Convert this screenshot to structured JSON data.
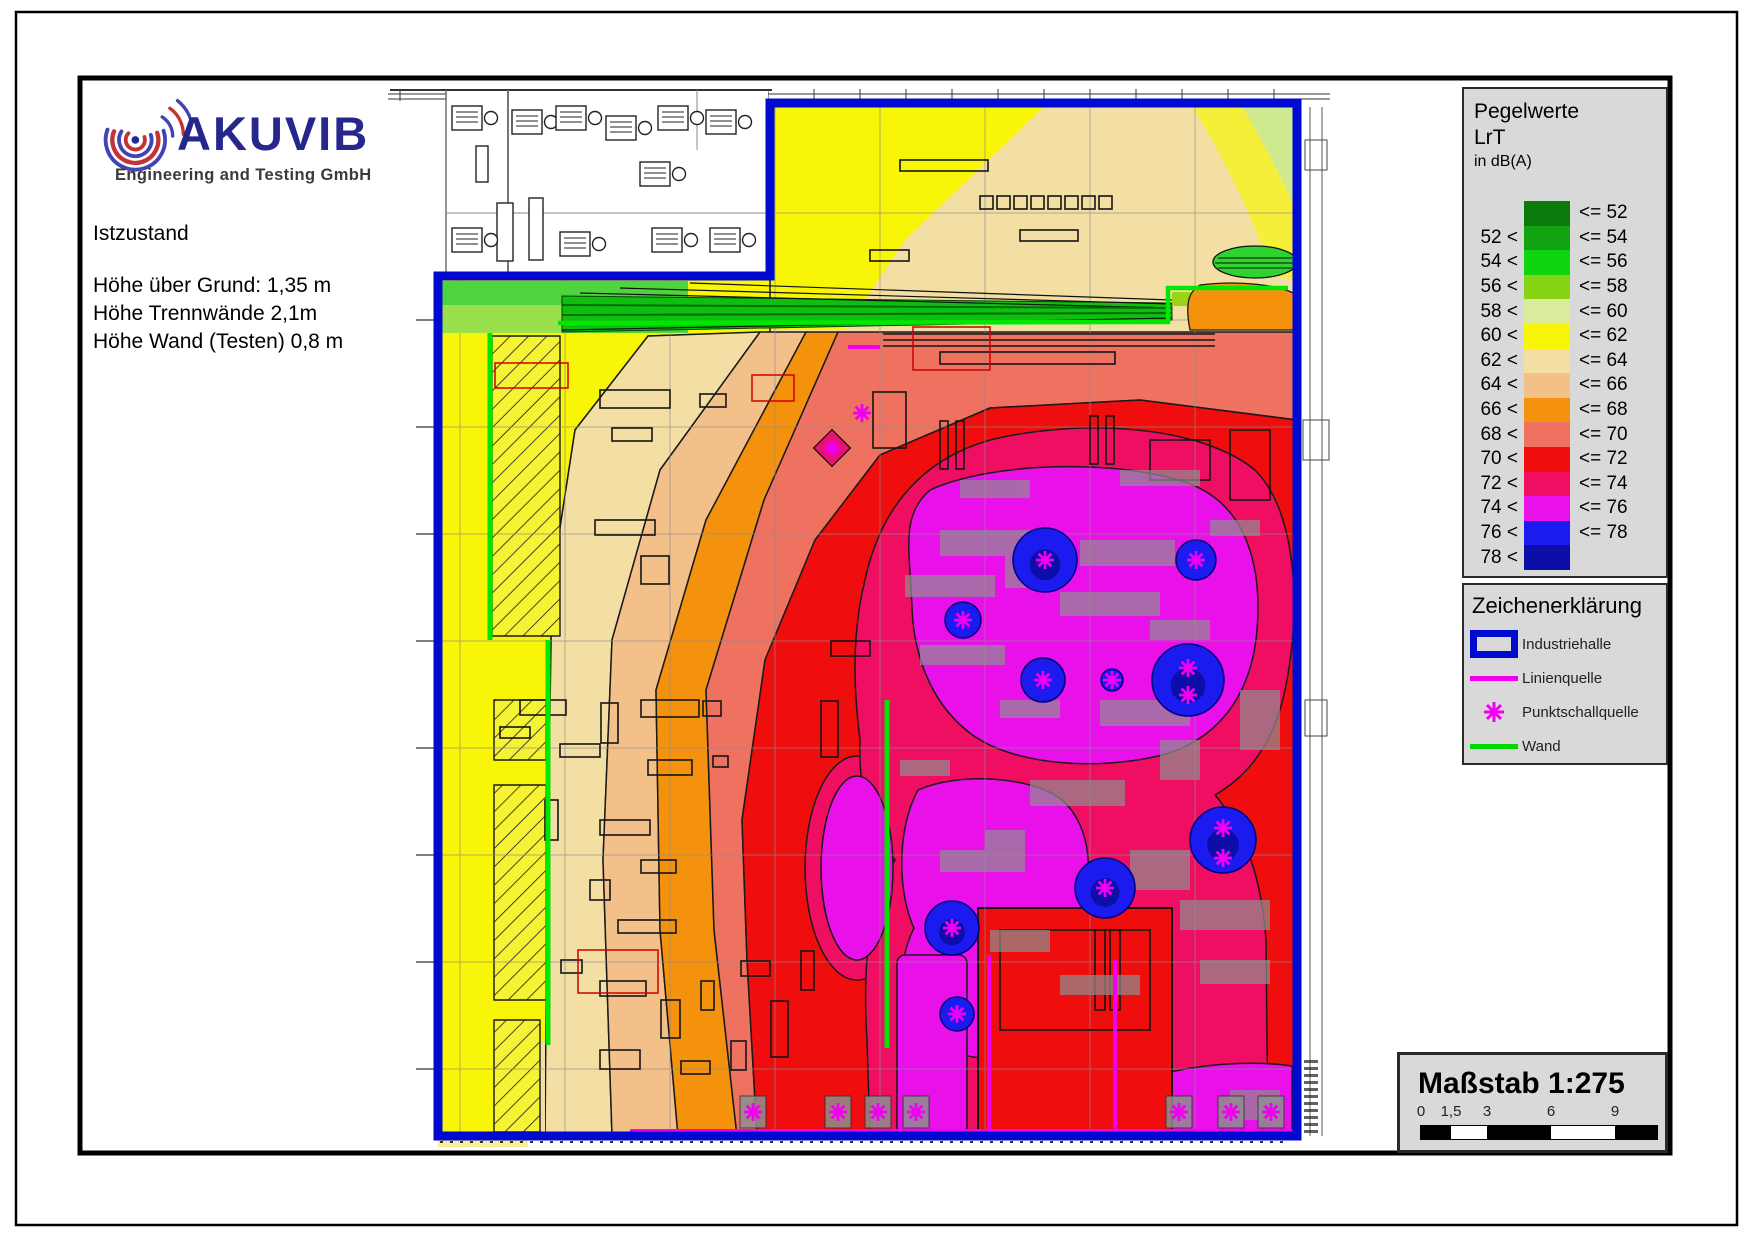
{
  "logo": {
    "brand": "AKUVIB",
    "subtitle": "Engineering and Testing GmbH"
  },
  "info": {
    "line1": "Istzustand",
    "line2": "Höhe über Grund: 1,35 m",
    "line3": "Höhe Trennwände 2,1m",
    "line4": "Höhe Wand (Testen) 0,8 m"
  },
  "legend": {
    "title1": "Pegelwerte",
    "title2": "LrT",
    "title3": "in dB(A)",
    "unit": "dB(A)",
    "rows": [
      {
        "left": "",
        "right": "<= 52",
        "color": "#0a7a0a"
      },
      {
        "left": "52 <",
        "right": "<= 54",
        "color": "#12a312"
      },
      {
        "left": "54 <",
        "right": "<= 56",
        "color": "#0ed50e"
      },
      {
        "left": "56 <",
        "right": "<= 58",
        "color": "#86d414"
      },
      {
        "left": "58 <",
        "right": "<= 60",
        "color": "#d9ec9b"
      },
      {
        "left": "60 <",
        "right": "<= 62",
        "color": "#f8f506"
      },
      {
        "left": "62 <",
        "right": "<= 64",
        "color": "#f3dfa4"
      },
      {
        "left": "64 <",
        "right": "<= 66",
        "color": "#f4c089"
      },
      {
        "left": "66 <",
        "right": "<= 68",
        "color": "#f4920e"
      },
      {
        "left": "68 <",
        "right": "<= 70",
        "color": "#ef7261"
      },
      {
        "left": "70 <",
        "right": "<= 72",
        "color": "#f00d0d"
      },
      {
        "left": "72 <",
        "right": "<= 74",
        "color": "#ef0e62"
      },
      {
        "left": "74 <",
        "right": "<= 76",
        "color": "#ea10ea"
      },
      {
        "left": "76 <",
        "right": "<= 78",
        "color": "#1b1bf0"
      },
      {
        "left": "78 <",
        "right": "",
        "color": "#0d0da8"
      }
    ]
  },
  "symbols": {
    "title": "Zeichenerklärung",
    "items": [
      {
        "type": "hall",
        "label": "Industriehalle"
      },
      {
        "type": "line",
        "label": "Linienquelle"
      },
      {
        "type": "point",
        "label": "Punktschallquelle"
      },
      {
        "type": "wall",
        "label": "Wand"
      }
    ]
  },
  "scalebox": {
    "title": "Maßstab 1:275",
    "ticks": [
      "0",
      "1,5",
      "3",
      "6",
      "9"
    ],
    "tick_px": [
      21,
      51,
      87,
      151,
      215
    ],
    "segments_px": [
      30,
      36,
      64,
      64,
      42
    ],
    "segment_colors": [
      "#000000",
      "#ffffff",
      "#000000",
      "#ffffff",
      "#000000"
    ]
  },
  "map": {
    "accent_colors": {
      "hall_boundary": "#0009d0",
      "wall": "#00e600",
      "source": "#f000f0"
    },
    "blobs": [
      [
        1045,
        560,
        32
      ],
      [
        1196,
        560,
        20
      ],
      [
        963,
        620,
        18
      ],
      [
        1043,
        680,
        22
      ],
      [
        1188,
        680,
        36
      ],
      [
        1112,
        680,
        11
      ],
      [
        952,
        928,
        27
      ],
      [
        957,
        1014,
        17
      ],
      [
        1105,
        888,
        30
      ],
      [
        1223,
        840,
        33
      ]
    ],
    "asterisks": [
      [
        1045,
        560
      ],
      [
        1196,
        560
      ],
      [
        963,
        620
      ],
      [
        1043,
        680
      ],
      [
        1188,
        668
      ],
      [
        1188,
        695
      ],
      [
        1112,
        680
      ],
      [
        952,
        928
      ],
      [
        957,
        1014
      ],
      [
        1105,
        888
      ],
      [
        1223,
        828
      ],
      [
        1223,
        858
      ],
      [
        862,
        413
      ],
      [
        832,
        448
      ],
      [
        753,
        1112
      ],
      [
        838,
        1112
      ],
      [
        878,
        1112
      ],
      [
        916,
        1112
      ],
      [
        1179,
        1112
      ],
      [
        1231,
        1112
      ],
      [
        1271,
        1112
      ]
    ],
    "source_boxes": [
      [
        753,
        1112
      ],
      [
        838,
        1112
      ],
      [
        878,
        1112
      ],
      [
        916,
        1112
      ],
      [
        1179,
        1112
      ],
      [
        1231,
        1112
      ],
      [
        1271,
        1112
      ]
    ],
    "line_sources": [
      [
        848,
        347,
        880,
        347
      ],
      [
        630,
        1131,
        1295,
        1131
      ],
      [
        989,
        955,
        989,
        1131
      ],
      [
        1115,
        960,
        1115,
        1131
      ]
    ],
    "walls": [
      [
        490,
        333,
        490,
        640
      ],
      [
        548,
        640,
        548,
        1045
      ],
      [
        887,
        700,
        887,
        1048
      ]
    ]
  }
}
